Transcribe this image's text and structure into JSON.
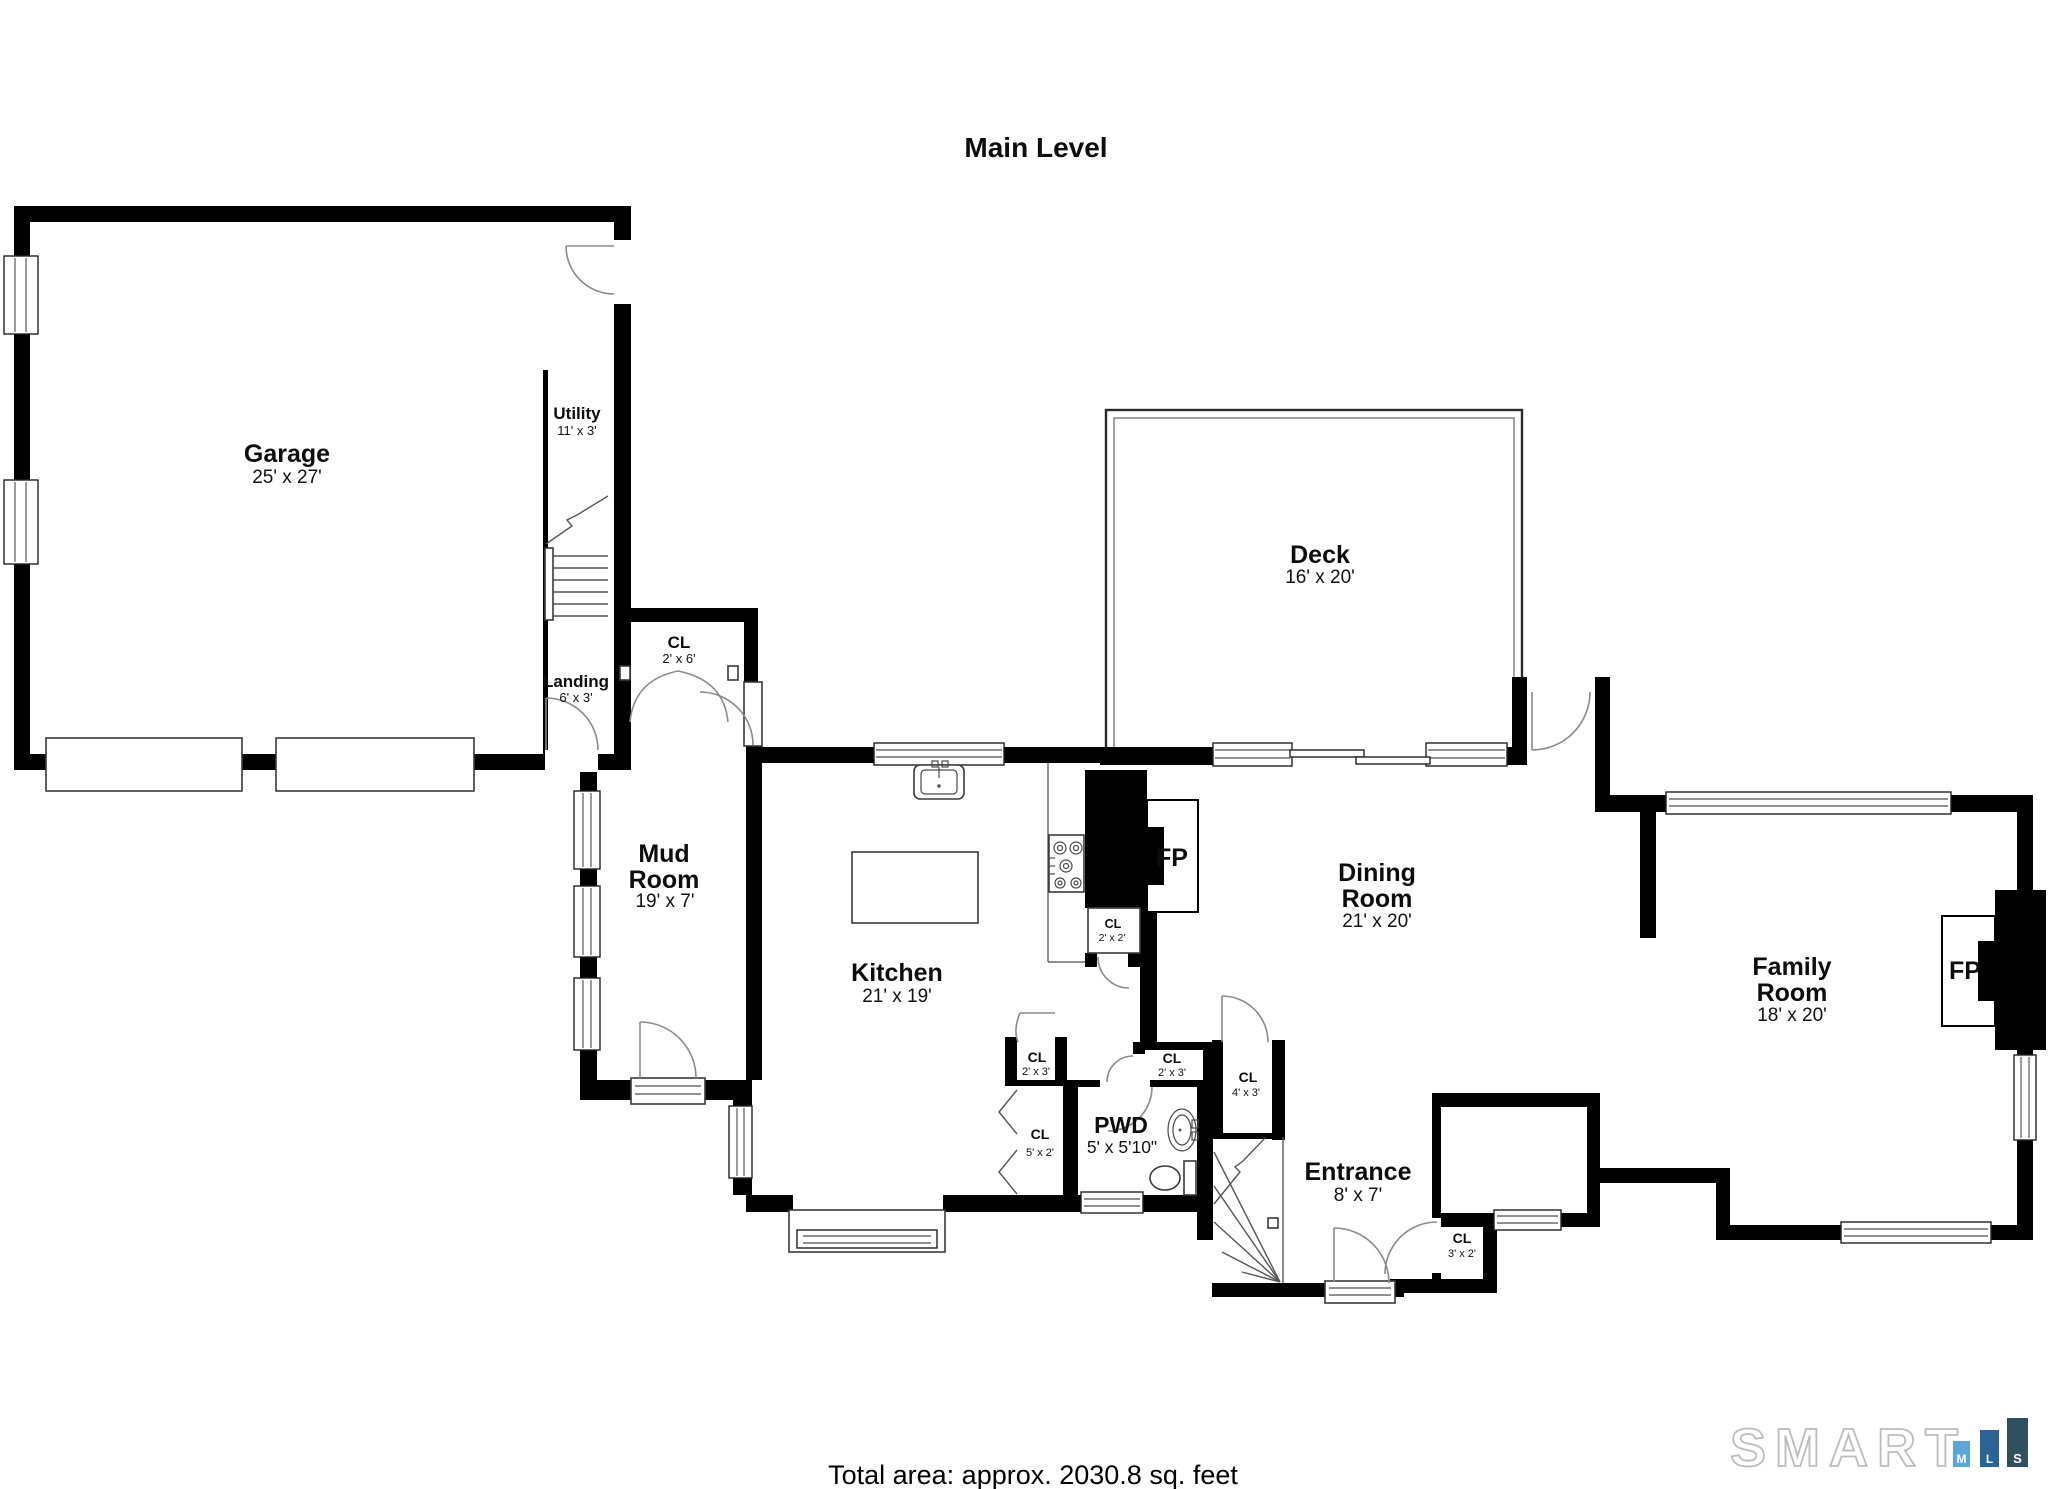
{
  "title": "Main Level",
  "footer": {
    "total_area": "Total area: approx. 2030.8 sq. feet"
  },
  "logo": {
    "word": "SMART",
    "blocks": [
      {
        "letter": "M",
        "color": "#5ba7d9"
      },
      {
        "letter": "L",
        "color": "#2a6496"
      },
      {
        "letter": "S",
        "color": "#31505f"
      }
    ]
  },
  "rooms": {
    "garage": {
      "name": "Garage",
      "dims": "25' x 27'"
    },
    "utility": {
      "name": "Utility",
      "dims": "11' x 3'"
    },
    "landing": {
      "name": "Landing",
      "dims": "6' x 3'"
    },
    "cl_2x6": {
      "name": "CL",
      "dims": "2' x 6'"
    },
    "deck": {
      "name": "Deck",
      "dims": "16' x 20'"
    },
    "mud_room": {
      "line1": "Mud",
      "line2": "Room",
      "dims": "19' x 7'"
    },
    "kitchen": {
      "name": "Kitchen",
      "dims": "21' x 19'"
    },
    "fp_kitchen": {
      "name": "FP"
    },
    "cl_2x2": {
      "name": "CL",
      "dims": "2' x 2'"
    },
    "dining_room": {
      "line1": "Dining",
      "line2": "Room",
      "dims": "21' x 20'"
    },
    "family_room": {
      "line1": "Family",
      "line2": "Room",
      "dims": "18' x 20'"
    },
    "fp_family": {
      "name": "FP"
    },
    "cl_2x3_a": {
      "name": "CL",
      "dims": "2' x 3'"
    },
    "cl_5x2": {
      "name": "CL",
      "dims": "5' x 2'"
    },
    "cl_2x3_b": {
      "name": "CL",
      "dims": "2' x 3'"
    },
    "cl_4x3": {
      "name": "CL",
      "dims": "4' x 3'"
    },
    "pwd": {
      "name": "PWD",
      "dims": "5' x 5'10\""
    },
    "entrance": {
      "name": "Entrance",
      "dims": "8' x 7'"
    },
    "cl_3x2": {
      "name": "CL",
      "dims": "3' x 2'"
    }
  }
}
